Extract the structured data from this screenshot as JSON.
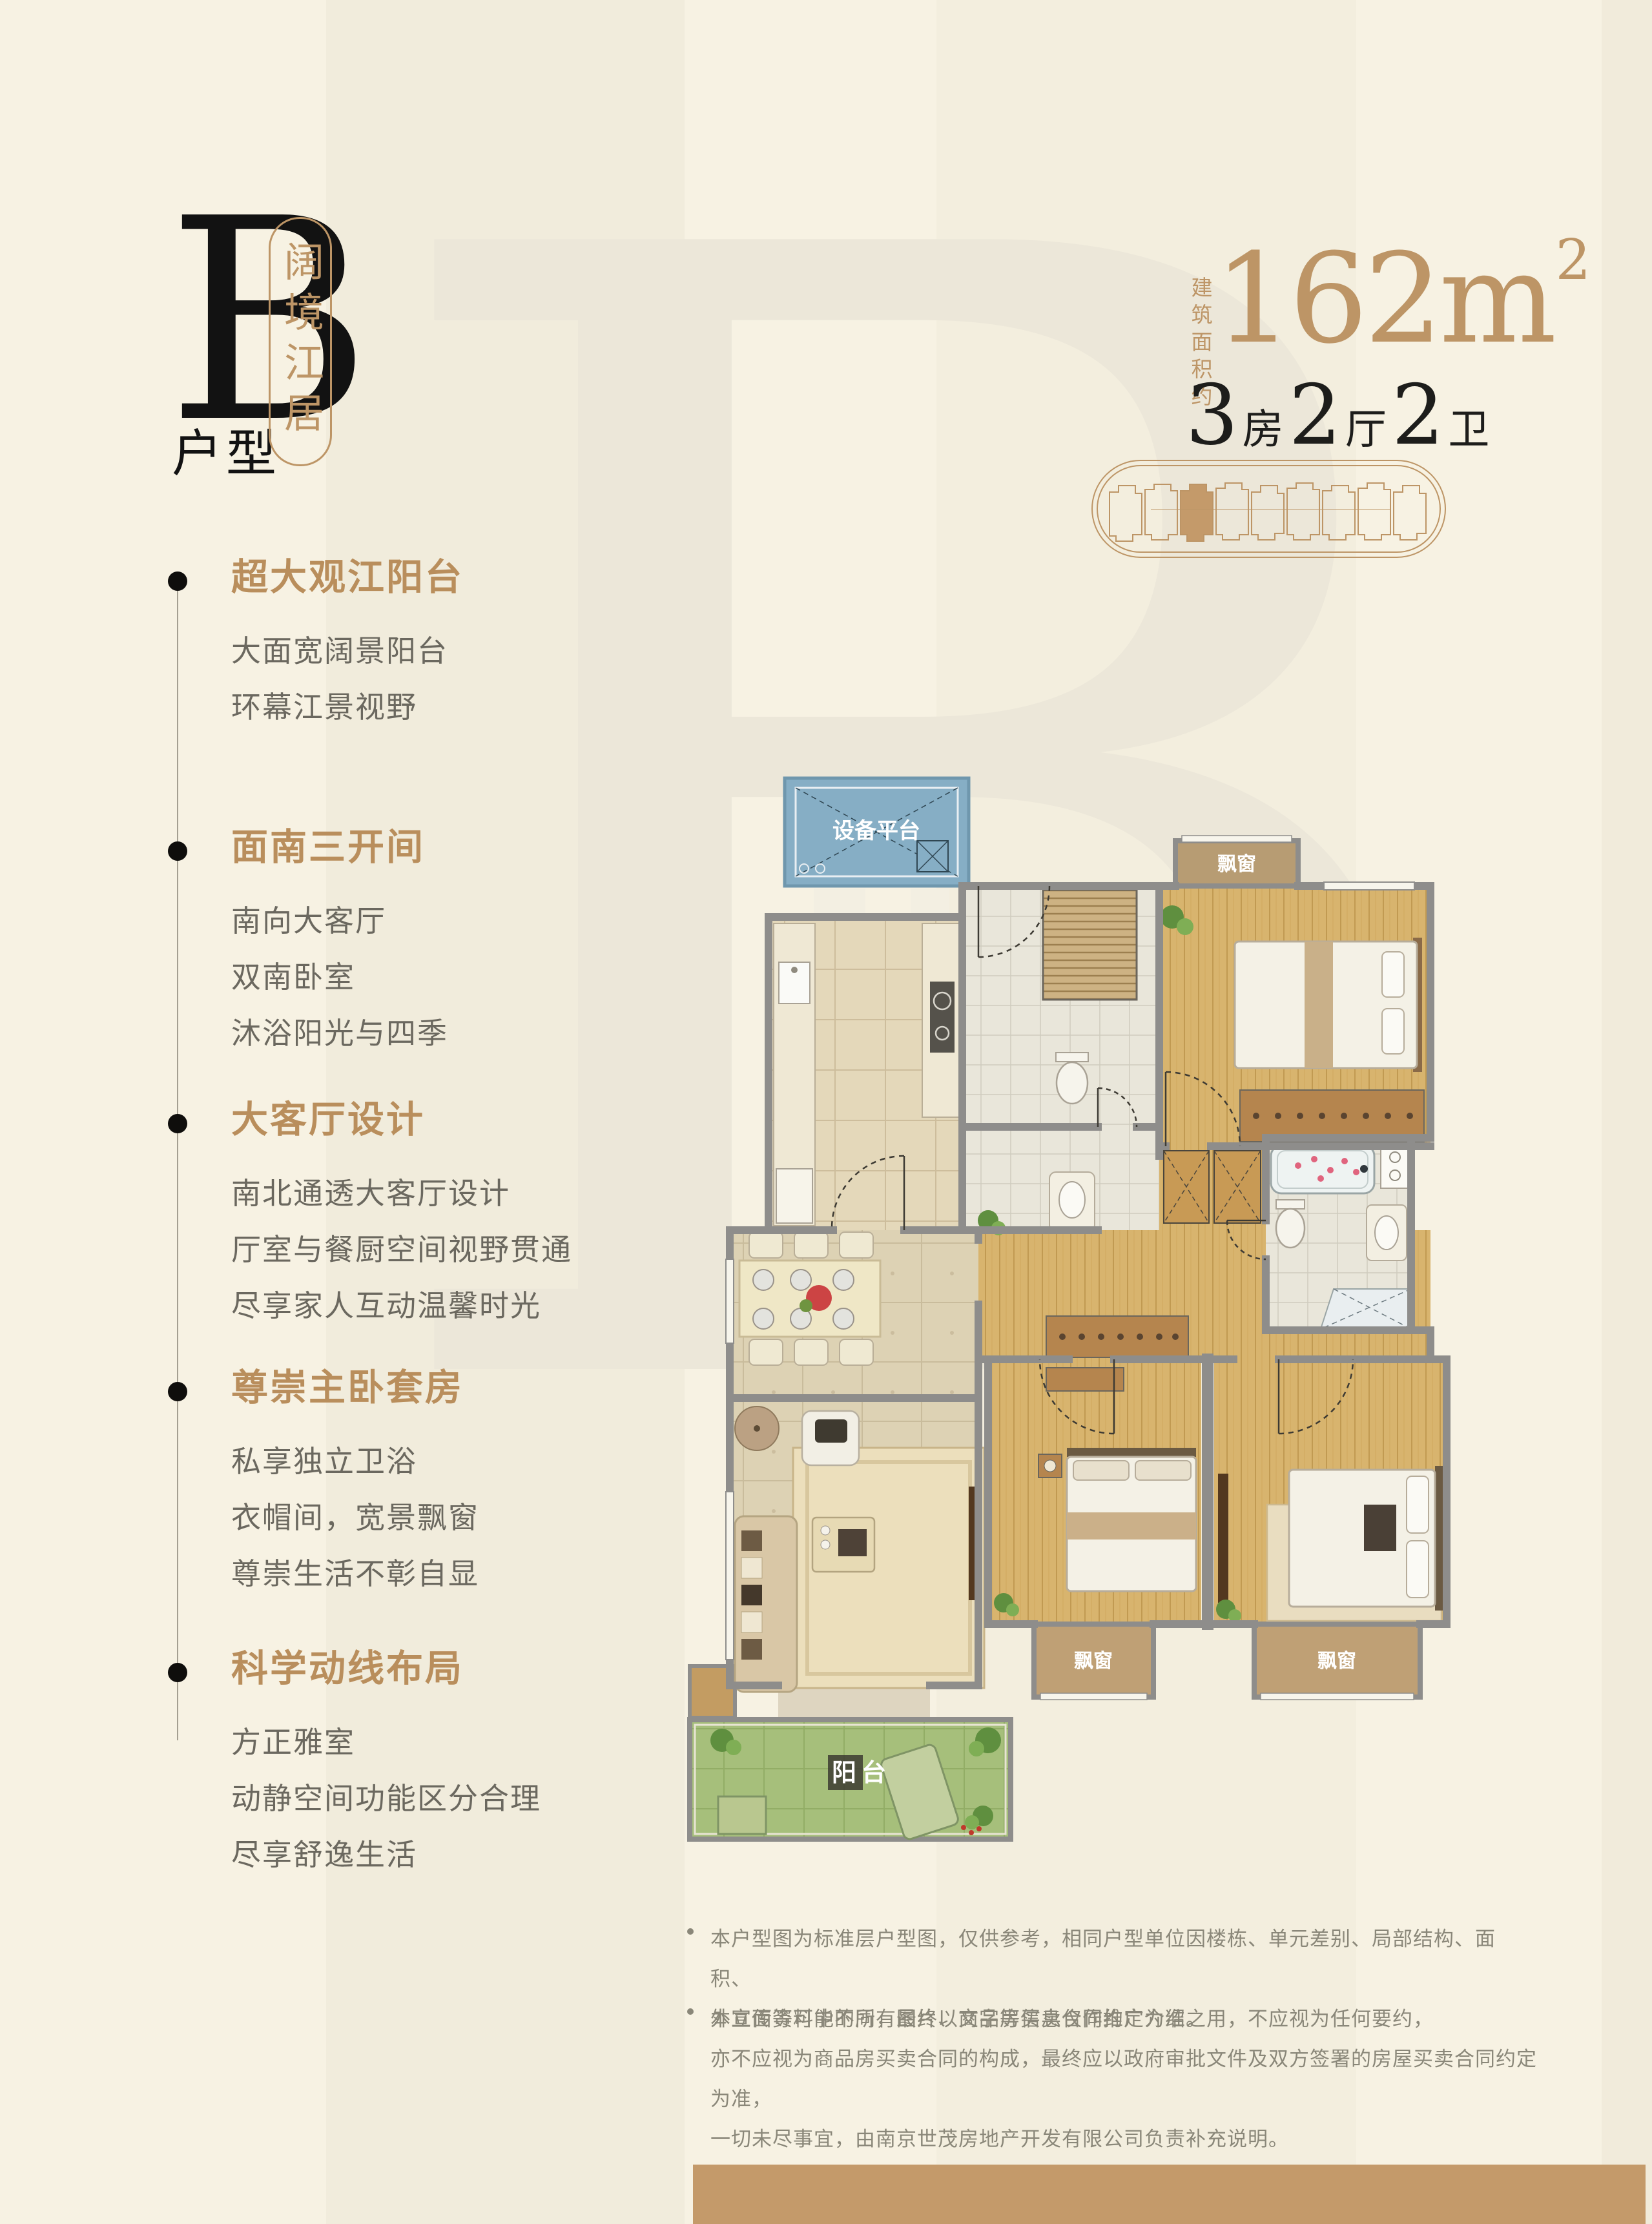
{
  "colors": {
    "background": "#f7f2e3",
    "accent_gold": "#bd9566",
    "ink_black": "#1d1d1b",
    "body_gray": "#6b685f",
    "muted_gray": "#8a8779",
    "footer_bar": "#c49a6a",
    "wall_gray": "#8e8d8b",
    "platform_blue": "#86aec5",
    "balcony_green": "#a6bf7b"
  },
  "logo": {
    "letter": "B",
    "type_label": "户型",
    "series_name": "阔境江居",
    "watermark_letter": "B"
  },
  "area": {
    "prefix": "建筑面积约",
    "value": "162",
    "unit": "m",
    "sup": "2"
  },
  "spec": {
    "parts": [
      {
        "n": "3",
        "u": "房"
      },
      {
        "n": "2",
        "u": "厅"
      },
      {
        "n": "2",
        "u": "卫"
      }
    ]
  },
  "features": [
    {
      "title": "超大观江阳台",
      "lines": [
        "大面宽阔景阳台",
        "环幕江景视野"
      ]
    },
    {
      "title": "面南三开间",
      "lines": [
        "南向大客厅",
        "双南卧室",
        "沐浴阳光与四季"
      ]
    },
    {
      "title": "大客厅设计",
      "lines": [
        "南北通透大客厅设计",
        "厅室与餐厨空间视野贯通",
        "尽享家人互动温馨时光"
      ]
    },
    {
      "title": "尊崇主卧套房",
      "lines": [
        "私享独立卫浴",
        "衣帽间，宽景飘窗",
        "尊崇生活不彰自显"
      ]
    },
    {
      "title": "科学动线布局",
      "lines": [
        "方正雅室",
        "动静空间功能区分合理",
        "尽享舒逸生活"
      ]
    }
  ],
  "plan": {
    "labels": {
      "equipment": "设备平台",
      "bay": "飘窗",
      "balcony": "阳台"
    }
  },
  "disclaimer": {
    "items": [
      {
        "lines": [
          "本户型图为标准层户型图，仅供参考，相同户型单位因楼栋、单元差别、局部结构、面积、",
          "外立面等可能不同，最终以商品房买卖合同约定为准。"
        ]
      },
      {
        "lines": [
          "本宣传资料中的所有图片、文字等信息仅作推广介绍之用，不应视为任何要约，",
          "亦不应视为商品房买卖合同的构成，最终应以政府审批文件及双方签署的房屋买卖合同约定为准，",
          "一切未尽事宜，由南京世茂房地产开发有限公司负责补充说明。"
        ]
      }
    ]
  }
}
